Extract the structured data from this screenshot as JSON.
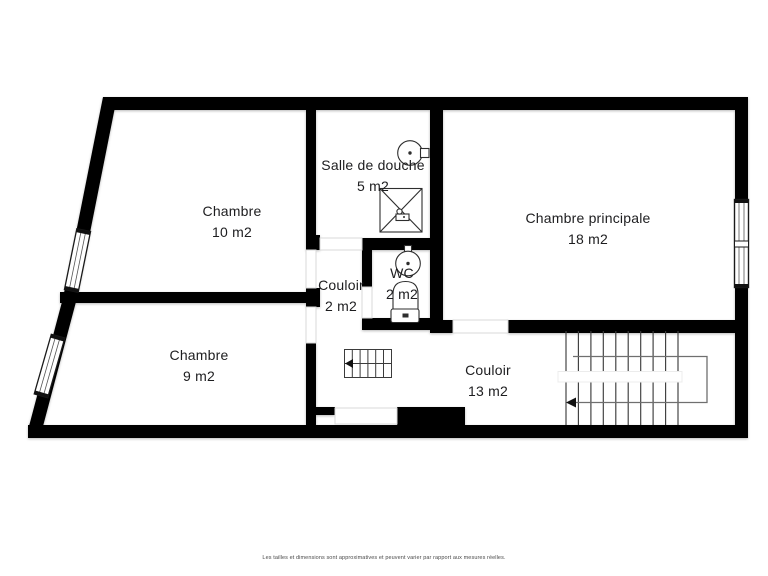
{
  "plan": {
    "rooms": [
      {
        "name": "Chambre",
        "area": "10 m2"
      },
      {
        "name": "Salle de douche",
        "area": "5 m2"
      },
      {
        "name": "Chambre principale",
        "area": "18 m2"
      },
      {
        "name": "Couloir",
        "area": "2 m2"
      },
      {
        "name": "WC",
        "area": "2 m2"
      },
      {
        "name": "Chambre",
        "area": "9 m2"
      },
      {
        "name": "Couloir",
        "area": "13 m2"
      }
    ],
    "disclaimer": "Les tailles et dimensions sont approximatives et peuvent varier par rapport aux mesures réelles.",
    "colors": {
      "wall": "#000000",
      "floor": "#ffffff",
      "background": "#ffffff",
      "fixture_stroke": "#2e2e2e",
      "door_outline": "#d8d8d8",
      "stair_guide": "#6f6f6f"
    },
    "icons": [
      "sink-icon",
      "shower-icon",
      "toilet-icon",
      "staircase-icon",
      "small-staircase-icon",
      "window",
      "door-opening",
      "direction-arrow-icon"
    ]
  }
}
